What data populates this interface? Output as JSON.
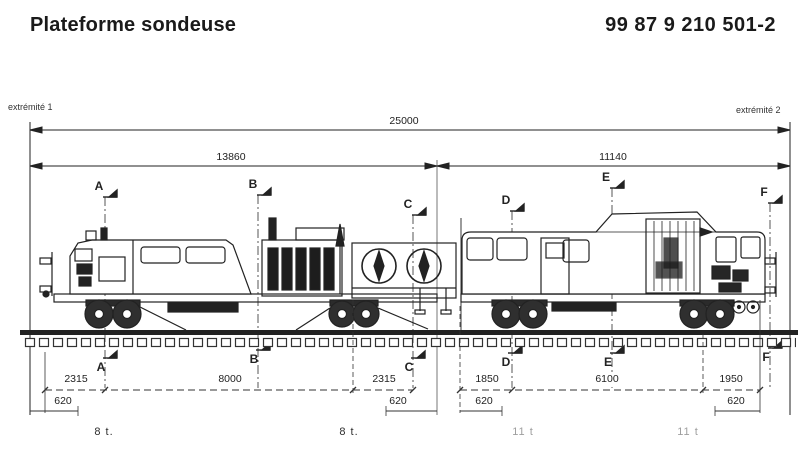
{
  "header": {
    "title": "Plateforme sondeuse",
    "number": "99 87 9 210 501-2"
  },
  "endpoints": {
    "left": "extrémité 1",
    "right": "extrémité 2"
  },
  "dimensions": {
    "overall": "25000",
    "front_section": "13860",
    "rear_section": "11140",
    "axle_spans": [
      "2315",
      "8000",
      "2315",
      "1850",
      "6100",
      "1950"
    ],
    "end_offsets": [
      "620",
      "620",
      "620",
      "620"
    ]
  },
  "sections": {
    "top": [
      "A",
      "B",
      "C",
      "D",
      "E",
      "F"
    ],
    "bottom": [
      "A",
      "B",
      "C",
      "D",
      "E",
      "F"
    ]
  },
  "axle_loads": [
    "8 t.",
    "8 t.",
    "11 t",
    "11 t"
  ],
  "colors": {
    "ink": "#222222",
    "faded_ink": "#9e9e9e",
    "background": "#ffffff"
  }
}
